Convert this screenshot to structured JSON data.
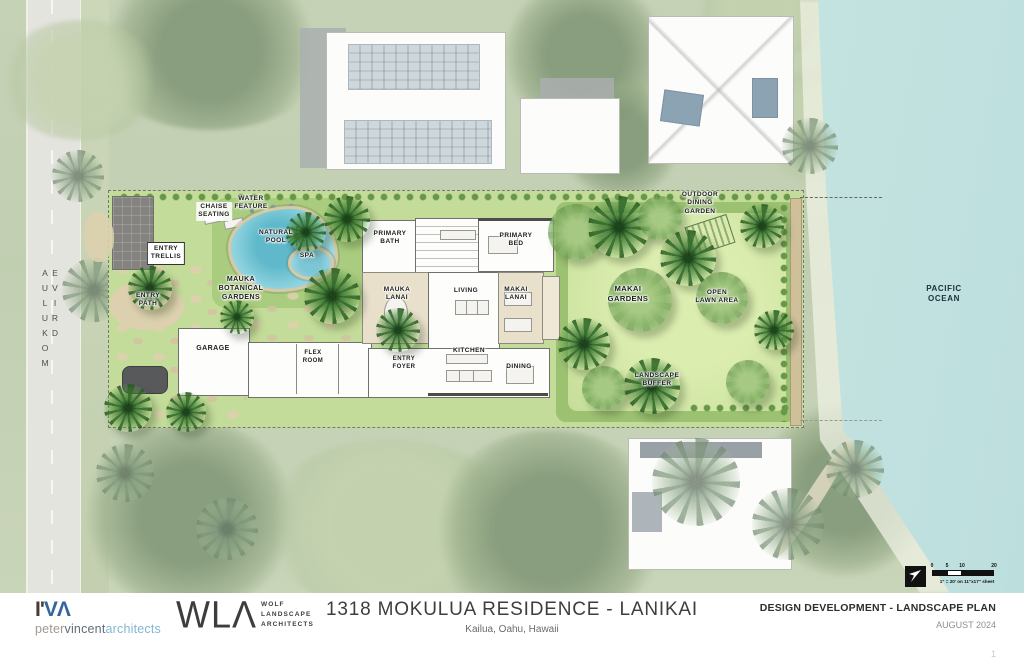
{
  "plan": {
    "street_label": "MOKULUA DRIVE",
    "ocean_label": "PACIFIC\nOCEAN",
    "labels": {
      "chaise_seating": "CHAISE\nSEATING",
      "water_feature": "WATER\nFEATURE",
      "entry_trellis": "ENTRY\nTRELLIS",
      "natural_pool": "NATURAL\nPOOL",
      "spa": "SPA",
      "mauka_botanical_gardens": "MAUKA\nBOTANICAL\nGARDENS",
      "entry_path": "ENTRY\nPATH",
      "garage": "GARAGE",
      "primary_bath": "PRIMARY\nBATH",
      "primary_bed": "PRIMARY\nBED",
      "mauka_lanai": "MAUKA\nLANAI",
      "living": "LIVING",
      "makai_lanai": "MAKAI\nLANAI",
      "flex_room": "FLEX\nROOM",
      "entry_foyer": "ENTRY\nFOYER",
      "kitchen": "KITCHEN",
      "dining": "DINING",
      "makai_gardens": "MAKAI\nGARDENS",
      "outdoor_dining_garden": "OUTDOOR\nDINING\nGARDEN",
      "open_lawn_area": "OPEN\nLAWN AREA",
      "landscape_buffer": "LANDSCAPE\nBUFFER"
    }
  },
  "scale_bar": {
    "ticks": [
      "0",
      "5",
      "10",
      "20"
    ],
    "caption": "1\" = 20' on 11\"x17\" sheet"
  },
  "title_block": {
    "pva_logo": {
      "mark_left": "I'",
      "mark_right": "VΛ",
      "name_peter": "peter",
      "name_vincent": "vincent",
      "name_architects": "architects"
    },
    "wla_logo": {
      "mark": "WLΛ",
      "line1": "WOLF",
      "line2": "LANDSCAPE",
      "line3": "ARCHITECTS"
    },
    "project_title": "1318 MOKULUA RESIDENCE - LANIKAI",
    "project_location": "Kailua, Oahu, Hawaii",
    "sheet_title": "DESIGN DEVELOPMENT - LANDSCAPE PLAN",
    "sheet_date": "AUGUST 2024",
    "sheet_number": "1"
  },
  "colors": {
    "ocean_water": "#a9d8d4",
    "lawn_green": "#cfe5a3",
    "pool_water": "#7fc9d8",
    "logo_blue": "#34659c",
    "logo_light_blue": "#84b6d3"
  }
}
